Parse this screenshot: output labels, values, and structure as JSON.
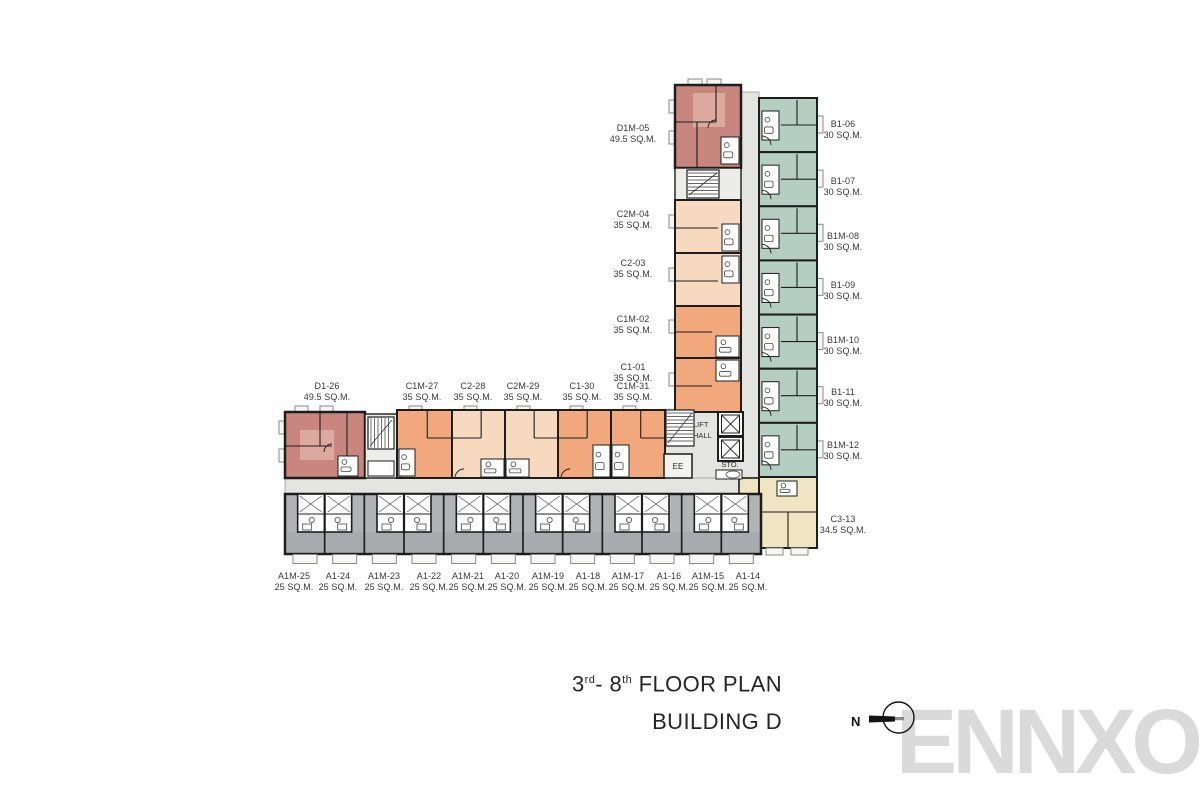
{
  "header": {
    "title": {
      "part1": "3",
      "sup1": "rd",
      "part2": "- 8",
      "sup2": "th",
      "part3": " FLOOR PLAN"
    },
    "building": "BUILDING D",
    "north_label": "N",
    "watermark": "ENNXO"
  },
  "core": {
    "lift_line1": "LIFT",
    "lift_line2": "HALL",
    "storage": "STO.",
    "electrical": "EE"
  },
  "units": {
    "vleft": [
      {
        "name": "D1M-05",
        "size": "49.5 SQ.M."
      },
      {
        "name": "C2M-04",
        "size": "35 SQ.M."
      },
      {
        "name": "C2-03",
        "size": "35 SQ.M."
      },
      {
        "name": "C1M-02",
        "size": "35 SQ.M."
      },
      {
        "name": "C1-01",
        "size": "35 SQ.M."
      }
    ],
    "vright": [
      {
        "name": "B1-06",
        "size": "30 SQ.M."
      },
      {
        "name": "B1-07",
        "size": "30 SQ.M."
      },
      {
        "name": "B1M-08",
        "size": "30 SQ.M."
      },
      {
        "name": "B1-09",
        "size": "30 SQ.M."
      },
      {
        "name": "B1M-10",
        "size": "30 SQ.M."
      },
      {
        "name": "B1-11",
        "size": "30 SQ.M."
      },
      {
        "name": "B1M-12",
        "size": "30 SQ.M."
      },
      {
        "name": "C3-13",
        "size": "34.5 SQ.M."
      }
    ],
    "htop": [
      {
        "name": "D1-26",
        "size": "49.5 SQ.M."
      },
      {
        "name": "C1M-27",
        "size": "35 SQ.M."
      },
      {
        "name": "C2-28",
        "size": "35 SQ.M."
      },
      {
        "name": "C2M-29",
        "size": "35 SQ.M."
      },
      {
        "name": "C1-30",
        "size": "35 SQ.M."
      },
      {
        "name": "C1M-31",
        "size": "35 SQ.M."
      }
    ],
    "hbottom": [
      {
        "name": "A1M-25",
        "size": "25 SQ.M."
      },
      {
        "name": "A1-24",
        "size": "25 SQ.M."
      },
      {
        "name": "A1M-23",
        "size": "25 SQ.M."
      },
      {
        "name": "A1-22",
        "size": "25 SQ.M."
      },
      {
        "name": "A1M-21",
        "size": "25 SQ.M."
      },
      {
        "name": "A1-20",
        "size": "25 SQ.M."
      },
      {
        "name": "A1M-19",
        "size": "25 SQ.M."
      },
      {
        "name": "A1-18",
        "size": "25 SQ.M."
      },
      {
        "name": "A1M-17",
        "size": "25 SQ.M."
      },
      {
        "name": "A1-16",
        "size": "25 SQ.M."
      },
      {
        "name": "A1M-15",
        "size": "25 SQ.M."
      },
      {
        "name": "A1-14",
        "size": "25 SQ.M."
      }
    ]
  },
  "colors": {
    "red": "#c9867e",
    "red_light": "#dca99f",
    "peach": "#f7d9bf",
    "orange": "#f2a87d",
    "green": "#b5cec2",
    "yellow": "#f0e5c2",
    "gray": "#b2b3b7",
    "gray_dark": "#a9aaae",
    "corridor": "#e4e4e0",
    "service": "#ecece8",
    "tab": "#f6f6f3",
    "wall": "#1d1d1d",
    "watermark": "#dadada",
    "label_text": "#383838"
  }
}
